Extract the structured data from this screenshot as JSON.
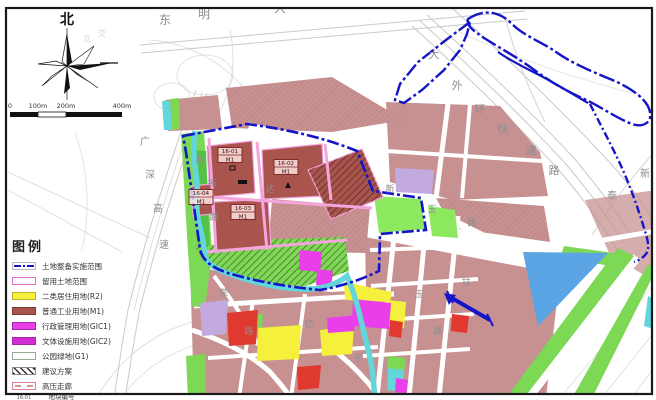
{
  "colors": {
    "frame": "#1a1a1a",
    "bg": "#ffffff",
    "road_line": "#c9c9c9",
    "road_label": "#8d8d8d",
    "boundary_blue": "#1414c8",
    "stream_cyan": "#62d6da",
    "mauve": "#c79191",
    "m1_red": "#a9544c",
    "m1_street_pink": "#f2a6dc",
    "yellow": "#f4f03c",
    "green": "#7dd955",
    "green_bright": "#8ce95f",
    "green_dark": "#54c244",
    "magenta": "#e93ee9",
    "magenta2": "#d42ad4",
    "lavender": "#c2aade",
    "water_blue": "#5ba5e4",
    "red": "#e0392f",
    "label_dark": "#40100e"
  },
  "compass": {
    "north_label": "北"
  },
  "scalebar": {
    "labels": [
      {
        "text": "0",
        "x": 10
      },
      {
        "text": "100m",
        "x": 38
      },
      {
        "text": "200m",
        "x": 66
      },
      {
        "text": "400m",
        "x": 122
      }
    ]
  },
  "legend": {
    "title": "图例",
    "items": [
      {
        "label": "土地整备实施范围",
        "swatch": "boundary"
      },
      {
        "label": "留用土地范围",
        "swatch": "reserved"
      },
      {
        "label": "二类居住用地(R2)",
        "swatch": "r2"
      },
      {
        "label": "普通工业用地(M1)",
        "swatch": "m1"
      },
      {
        "label": "行政管理用地(GIC1)",
        "swatch": "gic1"
      },
      {
        "label": "文体设施用地(GIC2)",
        "swatch": "gic2"
      },
      {
        "label": "公园绿地(G1)",
        "swatch": "g1"
      },
      {
        "label": "建议方案",
        "swatch": "proposal"
      },
      {
        "label": "高压走廊",
        "swatch": "hv"
      },
      {
        "swatch": "plotcode",
        "numerator": "地块编号",
        "denominator": "用地性质代码",
        "sample_code": "16-01",
        "sample_use": "M1"
      }
    ]
  },
  "map": {
    "parcel_labels": [
      {
        "code": "16-01",
        "use": "M1",
        "x": 230,
        "y": 155
      },
      {
        "code": "16-02",
        "use": "M1",
        "x": 286,
        "y": 167
      },
      {
        "code": "16-03",
        "use": "M1",
        "x": 243,
        "y": 212
      },
      {
        "code": "16-04",
        "use": "M1",
        "x": 201,
        "y": 197
      }
    ],
    "road_labels": [
      {
        "text": "东",
        "x": 165,
        "y": 24,
        "size": 12
      },
      {
        "text": "明",
        "x": 204,
        "y": 18,
        "size": 12
      },
      {
        "text": "大",
        "x": 280,
        "y": 12,
        "size": 12
      },
      {
        "text": "大",
        "x": 434,
        "y": 58,
        "size": 11
      },
      {
        "text": "外",
        "x": 457,
        "y": 89,
        "size": 11
      },
      {
        "text": "环",
        "x": 480,
        "y": 113,
        "size": 11
      },
      {
        "text": "快",
        "x": 503,
        "y": 133,
        "size": 11
      },
      {
        "text": "速",
        "x": 531,
        "y": 154,
        "size": 11
      },
      {
        "text": "路",
        "x": 554,
        "y": 174,
        "size": 11
      },
      {
        "text": "新",
        "x": 645,
        "y": 177,
        "size": 10
      },
      {
        "text": "泰",
        "x": 612,
        "y": 199,
        "size": 10
      },
      {
        "text": "广",
        "x": 145,
        "y": 145,
        "size": 10
      },
      {
        "text": "深",
        "x": 150,
        "y": 178,
        "size": 10
      },
      {
        "text": "高",
        "x": 158,
        "y": 212,
        "size": 10
      },
      {
        "text": "速",
        "x": 164,
        "y": 248,
        "size": 10
      },
      {
        "text": "新",
        "x": 200,
        "y": 163,
        "size": 9
      },
      {
        "text": "拓",
        "x": 212,
        "y": 186,
        "size": 9
      },
      {
        "text": "路",
        "x": 214,
        "y": 220,
        "size": 9
      },
      {
        "text": "达",
        "x": 270,
        "y": 192,
        "size": 9
      },
      {
        "text": "新",
        "x": 390,
        "y": 192,
        "size": 9
      },
      {
        "text": "玉",
        "x": 432,
        "y": 212,
        "size": 9
      },
      {
        "text": "路",
        "x": 472,
        "y": 226,
        "size": 9
      },
      {
        "text": "玉",
        "x": 419,
        "y": 297,
        "size": 9
      },
      {
        "text": "路",
        "x": 438,
        "y": 334,
        "size": 9
      },
      {
        "text": "甘",
        "x": 466,
        "y": 285,
        "size": 9
      },
      {
        "text": "荣",
        "x": 224,
        "y": 296,
        "size": 9
      },
      {
        "text": "路",
        "x": 249,
        "y": 334,
        "size": 9
      },
      {
        "text": "亿",
        "x": 309,
        "y": 327,
        "size": 9
      },
      {
        "text": "东",
        "x": 358,
        "y": 361,
        "size": 9
      },
      {
        "text": "立",
        "x": 87,
        "y": 41,
        "size": 8,
        "op": 0.4
      },
      {
        "text": "交",
        "x": 102,
        "y": 36,
        "size": 8,
        "op": 0.4
      }
    ]
  }
}
